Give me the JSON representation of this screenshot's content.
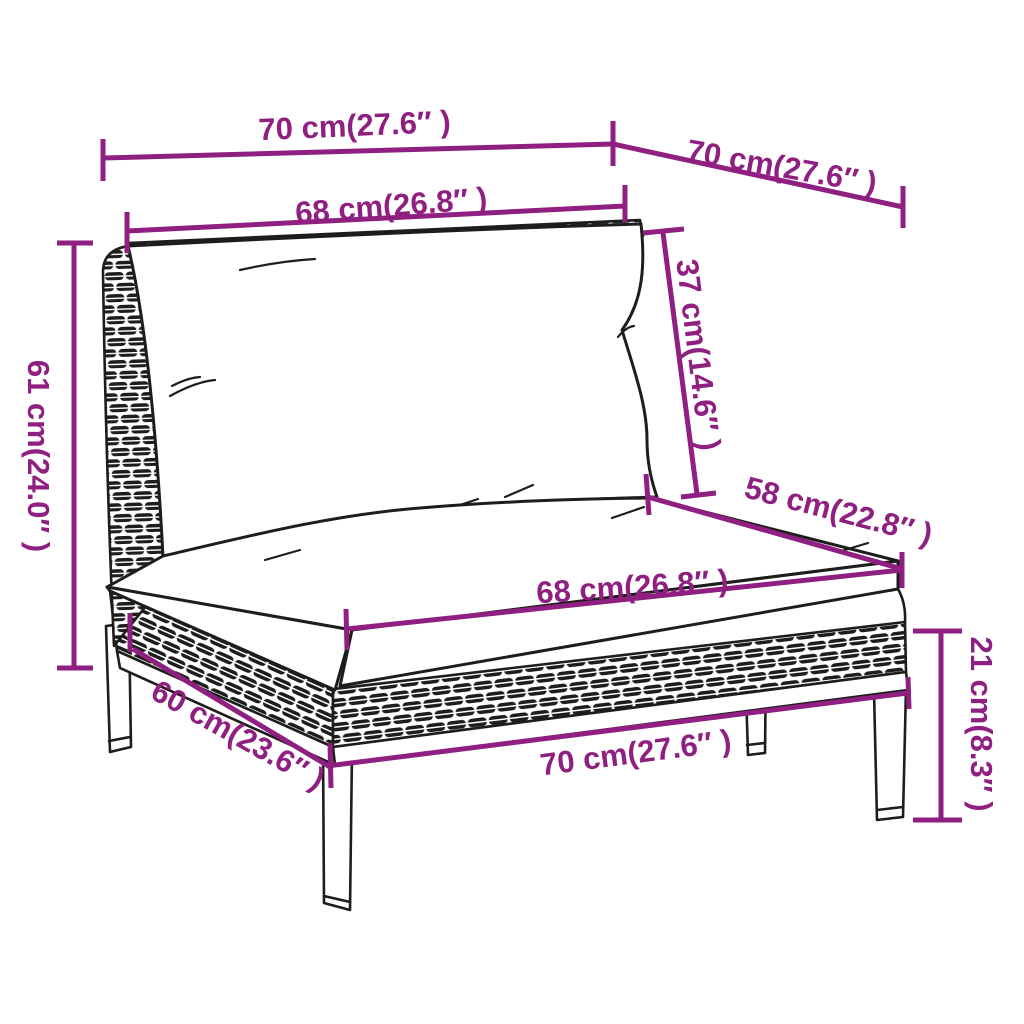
{
  "diagram": {
    "title": "Garden sofa middle section dimension diagram",
    "subject": "poly rattan sofa section with back and seat cushions",
    "colors": {
      "dimension_accent": "#8F1F80",
      "line_art": "#1D1D1B",
      "background": "#FFFFFF"
    },
    "labels": {
      "top_width": "70 cm(27.6″ )",
      "top_depth": "70 cm(27.6″ )",
      "back_cushion_width": "68 cm(26.8″ )",
      "back_cushion_height": "37 cm(14.6″ )",
      "back_height": "61 cm(24.0″ )",
      "seat_depth": "58 cm(22.8″ )",
      "seat_cushion_width": "68 cm(26.8″ )",
      "side_depth": "60 cm(23.6″ )",
      "base_width": "70 cm(27.6″ )",
      "leg_height": "21 cm(8.3″ )"
    }
  }
}
